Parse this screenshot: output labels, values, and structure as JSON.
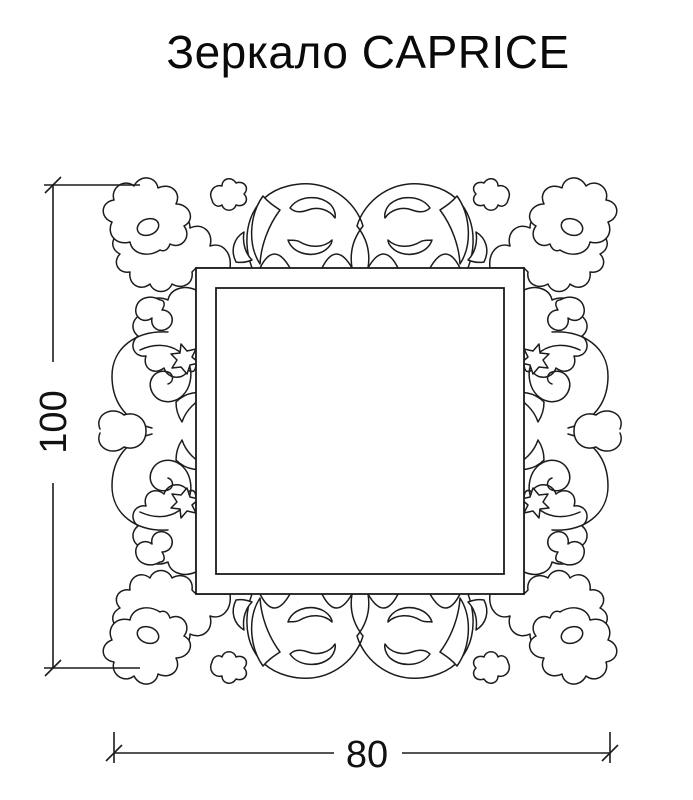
{
  "title": "Зеркало CAPRICE",
  "dimensions": {
    "height": "100",
    "width": "80"
  },
  "colors": {
    "background": "#ffffff",
    "line": "#1c1c1c",
    "text": "#0a0a0a"
  }
}
